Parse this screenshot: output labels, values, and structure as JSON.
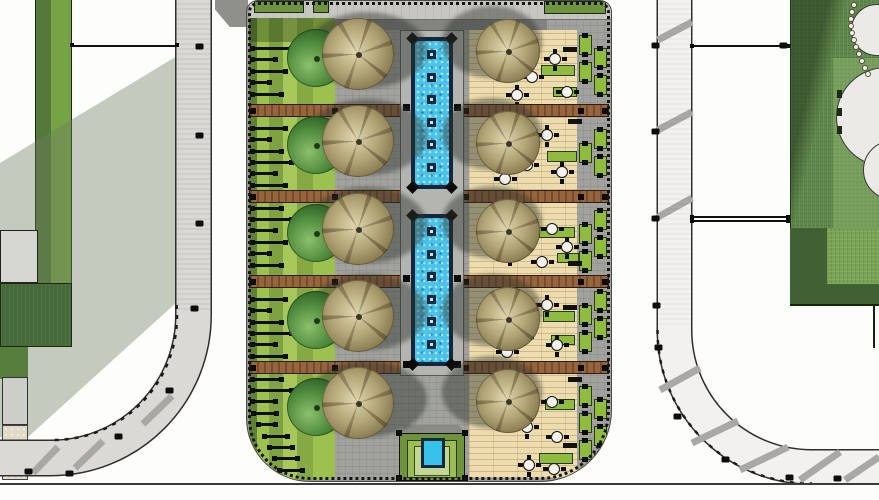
{
  "scene": {
    "type": "landscape-site-plan",
    "description": "Top-down rendered landscape plan: a linear plaza median with twin reflecting pools, a bosque of trees, bench garden strip, timber dining deck with planters, flanked by two curving roads, lawns and paved areas",
    "colors": {
      "paving": "#a1a19d",
      "walkway": "#c8c6c0",
      "water": "#49c3ea",
      "pool_frame": "#13273a",
      "deck": "#ecdcae",
      "wood_strip": "#96653e",
      "bench_green": "#9dc14f",
      "olive_green": "#5f8136",
      "lawn_dark": "#46693a",
      "lawn_mid": "#5e874a",
      "lawn_light": "#7aa253",
      "road_left": "#dad9d6",
      "road_right": "#f2f1ef",
      "shadow": "rgba(112,124,98,0.40)",
      "planter": "#8fbc3e",
      "tree_green": "#4e8a3c",
      "tree_tan": "#b3a678",
      "stripe_gray": "#a8a8a5",
      "line": "#111111"
    }
  },
  "plan": {
    "strips_y": [
      103,
      189,
      274,
      360
    ],
    "strip_posts_x": [
      0,
      82,
      151,
      213,
      328,
      352
    ],
    "fountains": [
      {
        "x": 164,
        "y": 36,
        "w": 42,
        "h": 152,
        "jets": 6,
        "connectors": [
          67
        ]
      },
      {
        "x": 164,
        "y": 213,
        "w": 42,
        "h": 152,
        "jets": 6,
        "connectors": [
          61,
          147
        ]
      }
    ],
    "bench": {
      "x": 4,
      "y0": 46,
      "step": 11.4,
      "h": 3,
      "widths": [
        42,
        26,
        36,
        20,
        32
      ],
      "until": 470
    },
    "planters": {
      "cols": [
        332,
        347
      ],
      "w": 13,
      "h": 20,
      "y0": 34,
      "step": 27,
      "until": 462
    },
    "deck_green": [
      [
        294,
        64,
        34,
        11
      ],
      [
        306,
        86,
        24,
        10
      ],
      [
        300,
        150,
        30,
        11
      ],
      [
        292,
        226,
        36,
        11
      ],
      [
        310,
        252,
        22,
        10
      ],
      [
        296,
        310,
        32,
        11
      ],
      [
        304,
        334,
        24,
        10
      ],
      [
        298,
        398,
        30,
        11
      ],
      [
        292,
        452,
        34,
        11
      ]
    ],
    "tables": [
      [
        254,
        55
      ],
      [
        279,
        70
      ],
      [
        302,
        52
      ],
      [
        314,
        85
      ],
      [
        264,
        88
      ],
      [
        259,
        130
      ],
      [
        294,
        128
      ],
      [
        274,
        158
      ],
      [
        309,
        165
      ],
      [
        252,
        172
      ],
      [
        264,
        218
      ],
      [
        299,
        222
      ],
      [
        257,
        247
      ],
      [
        289,
        255
      ],
      [
        314,
        240
      ],
      [
        259,
        300
      ],
      [
        294,
        298
      ],
      [
        269,
        330
      ],
      [
        304,
        338
      ],
      [
        254,
        345
      ],
      [
        264,
        390
      ],
      [
        299,
        395
      ],
      [
        274,
        420
      ],
      [
        304,
        430
      ],
      [
        276,
        458
      ],
      [
        301,
        462
      ]
    ],
    "loungers": [
      [
        316,
        46
      ],
      [
        321,
        118
      ],
      [
        316,
        190
      ],
      [
        321,
        260
      ],
      [
        316,
        304
      ],
      [
        321,
        376
      ],
      [
        316,
        442
      ]
    ],
    "trees_left": {
      "green_cx": 69,
      "tan_cx": 111,
      "green_d": 58,
      "tan_d": 72,
      "rows": [
        57,
        144,
        232,
        319,
        406
      ]
    },
    "trees_right": {
      "tan_cx": 261,
      "tan_d": 64,
      "rows": [
        50,
        142,
        230,
        318,
        400
      ]
    },
    "planters_top": [
      [
        7,
        0,
        50,
        12
      ],
      [
        66,
        0,
        16,
        12
      ],
      [
        297,
        0,
        62,
        13
      ]
    ],
    "road_posts": [
      [
        196,
        44
      ],
      [
        196,
        133
      ],
      [
        196,
        221
      ],
      [
        191,
        306
      ],
      [
        166,
        388
      ],
      [
        115,
        434
      ],
      [
        25,
        469
      ],
      [
        66,
        471
      ],
      [
        652,
        43
      ],
      [
        652,
        129
      ],
      [
        652,
        216
      ],
      [
        653,
        303
      ],
      [
        655,
        345
      ],
      [
        674,
        414
      ],
      [
        722,
        457
      ],
      [
        786,
        475
      ],
      [
        834,
        476
      ],
      [
        780,
        43
      ]
    ],
    "green_posts": [
      [
        837,
        90
      ],
      [
        837,
        108
      ],
      [
        837,
        126
      ]
    ],
    "tree_circles": [
      [
        851,
        4,
        52
      ],
      [
        836,
        67,
        100
      ],
      [
        863,
        140,
        60
      ]
    ],
    "bead_dots": [
      [
        851,
        2
      ],
      [
        849,
        9
      ],
      [
        848,
        16
      ],
      [
        848,
        23
      ],
      [
        849,
        30
      ],
      [
        851,
        37
      ],
      [
        853,
        44
      ],
      [
        856,
        51
      ],
      [
        859,
        58
      ],
      [
        862,
        65
      ],
      [
        865,
        71
      ]
    ],
    "hlines": [
      [
        72,
        45,
        105
      ],
      [
        692,
        45,
        96
      ],
      [
        692,
        216,
        96
      ],
      [
        692,
        220,
        96
      ]
    ],
    "ticks": [
      [
        70,
        43
      ],
      [
        175,
        43
      ],
      [
        690,
        44
      ],
      [
        786,
        44
      ],
      [
        690,
        215
      ],
      [
        786,
        215
      ],
      [
        690,
        219
      ],
      [
        786,
        219
      ]
    ]
  }
}
